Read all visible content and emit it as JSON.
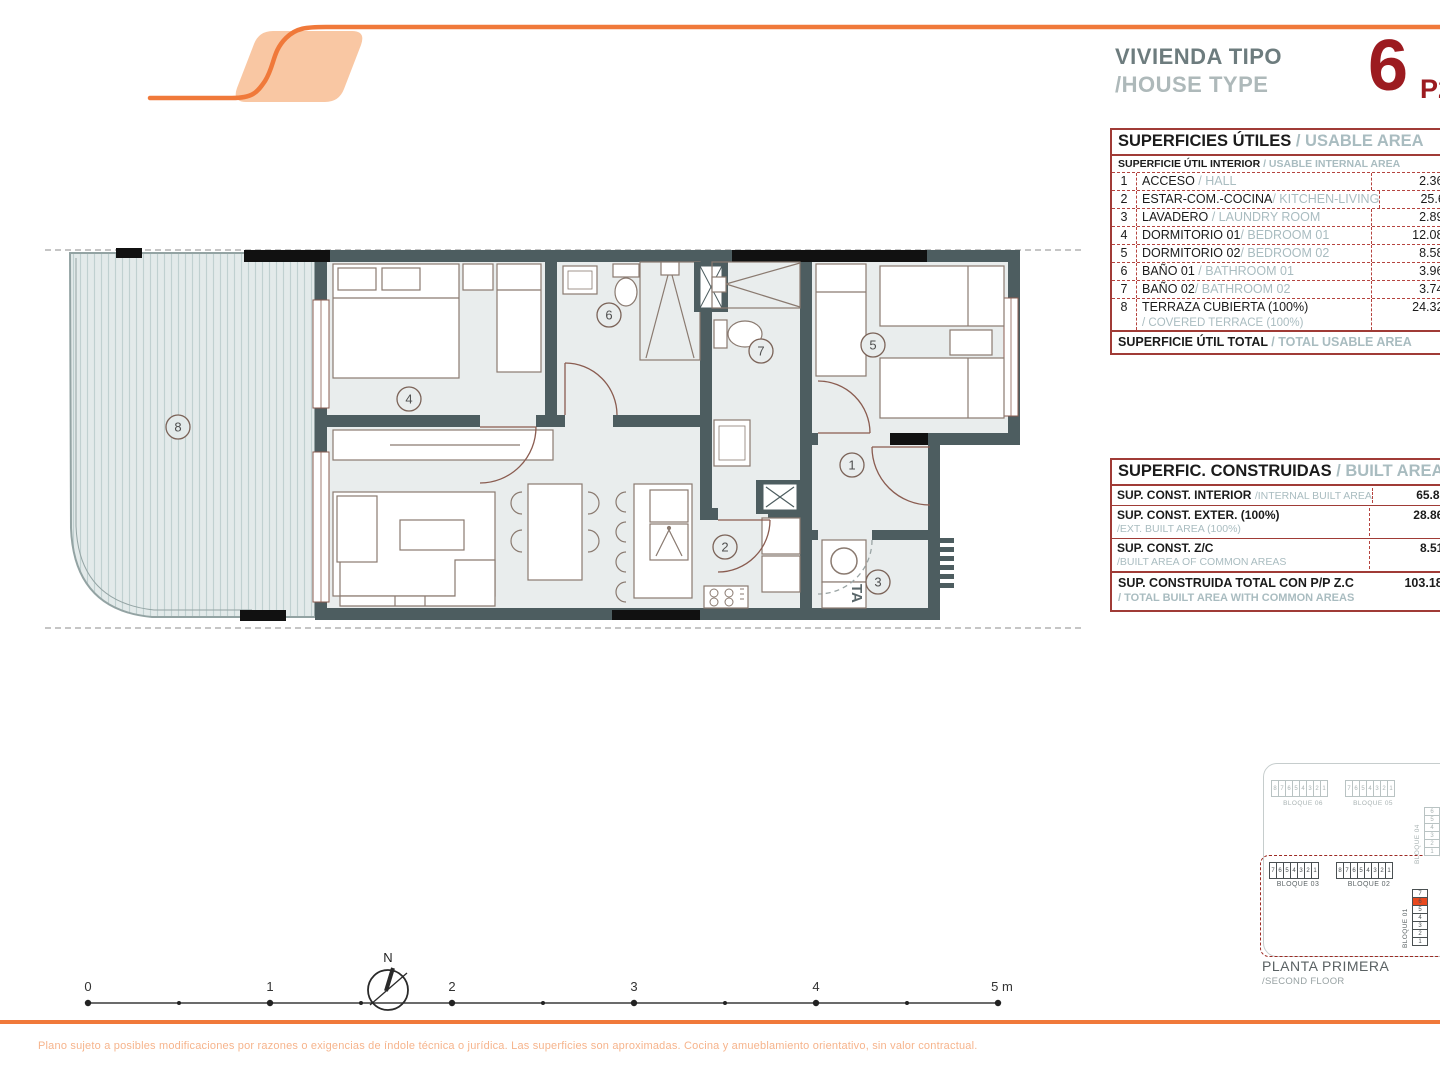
{
  "header": {
    "title_es": "VIVIENDA TIPO",
    "title_en": "/HOUSE TYPE",
    "type_number": "6",
    "floor_code": "P2"
  },
  "usable_table": {
    "title_es": "SUPERFICIES ÚTILES",
    "title_en": " / USABLE AREA",
    "subtitle_es": "SUPERFICIE ÚTIL INTERIOR",
    "subtitle_en": " / USABLE INTERNAL AREA",
    "rows": [
      {
        "num": "1",
        "es": "ACCESO",
        "en": " / HALL",
        "value": "2.36m²"
      },
      {
        "num": "2",
        "es": "ESTAR-COM.-COCINA",
        "en": "/ KITCHEN-LIVING",
        "value": "25.61m²"
      },
      {
        "num": "3",
        "es": "LAVADERO",
        "en": " / LAUNDRY ROOM",
        "value": "2.89m²"
      },
      {
        "num": "4",
        "es": "DORMITORIO 01",
        "en": "/ BEDROOM 01",
        "value": "12.08m²"
      },
      {
        "num": "5",
        "es": "DORMITORIO 02",
        "en": "/ BEDROOM 02",
        "value": "8.58m²"
      },
      {
        "num": "6",
        "es": "BAÑO 01",
        "en": " / BATHROOM 01",
        "value": "3.96m²"
      },
      {
        "num": "7",
        "es": "BAÑO 02",
        "en": "/ BATHROOM 02",
        "value": "3.74m²"
      },
      {
        "num": "8",
        "es": "TERRAZA CUBIERTA (100%)",
        "en": "/ COVERED TERRACE (100%)",
        "value": "24.32m²"
      }
    ],
    "total_es": "SUPERFICIE ÚTIL TOTAL",
    "total_en": " / TOTAL USABLE AREA",
    "total_value": "83.54m²"
  },
  "built_table": {
    "title_es": "SUPERFIC. CONSTRUIDAS",
    "title_en": " / BUILT AREA",
    "rows": [
      {
        "es": "SUP. CONST. INTERIOR",
        "en": "/INTERNAL BUILT AREA",
        "value": "65.81m²"
      },
      {
        "es": "SUP. CONST. EXTER. (100%)",
        "en": "/EXT. BUILT AREA (100%)",
        "value": "28.86m²"
      },
      {
        "es": "SUP. CONST. Z/C",
        "en": "/BUILT AREA OF COMMON AREAS",
        "value": "8.51m²"
      }
    ],
    "total_es": "SUP. CONSTRUIDA TOTAL CON P/P Z.C",
    "total_en": "/ TOTAL BUILT AREA WITH COMMON AREAS",
    "total_value": "103.18m²"
  },
  "plan": {
    "room_numbers": [
      "1",
      "2",
      "3",
      "4",
      "5",
      "6",
      "7",
      "8"
    ],
    "laundry_label": "TA"
  },
  "block_diagram": {
    "caption_es": "PLANTA PRIMERA",
    "caption_en": "/SECOND FLOOR",
    "b06": {
      "label": "BLOQUE 06",
      "cells": [
        "8",
        "7",
        "6",
        "5",
        "4",
        "3",
        "2",
        "1"
      ]
    },
    "b05": {
      "label": "BLOQUE 05",
      "cells": [
        "7",
        "6",
        "5",
        "4",
        "3",
        "2",
        "1"
      ]
    },
    "b04": {
      "label": "BLOQUE 04",
      "cells": [
        "6",
        "5",
        "4",
        "3",
        "2",
        "1"
      ]
    },
    "b03": {
      "label": "BLOQUE 03",
      "cells": [
        "7",
        "6",
        "5",
        "4",
        "3",
        "2",
        "1"
      ]
    },
    "b02": {
      "label": "BLOQUE 02",
      "cells": [
        "8",
        "7",
        "6",
        "5",
        "4",
        "3",
        "2",
        "1"
      ]
    },
    "b01": {
      "label": "BLOQUE 01",
      "cells": [
        "7",
        "6",
        "5",
        "4",
        "3",
        "2",
        "1"
      ],
      "highlighted_cell": "6"
    }
  },
  "scale_bar": {
    "labels": [
      "0",
      "1",
      "2",
      "3",
      "4",
      "5 m"
    ]
  },
  "compass": {
    "label": "N"
  },
  "footer": {
    "disclaimer": "Plano sujeto a posibles modificaciones por razones o exigencias de índole técnica o jurídica. Las superficies son aproximadas. Cocina y amueblamiento orientativo, sin valor contractual."
  },
  "colors": {
    "orange": "#F0793A",
    "peach": "#F9C7A3",
    "dark_red": "#9C1B20",
    "table_red": "#A03B36",
    "wall": "#4D5D60",
    "room_fill": "#E9EDED",
    "terrace_fill": "#E2EAEA",
    "highlight_cell": "#E8491F"
  }
}
